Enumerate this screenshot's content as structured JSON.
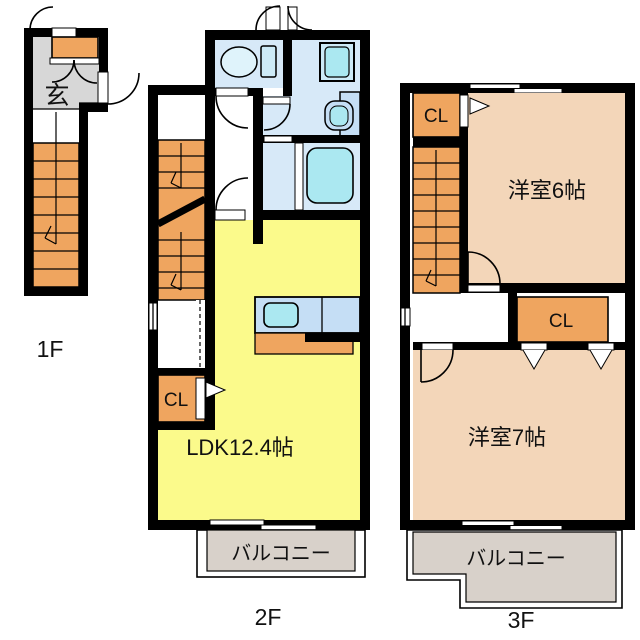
{
  "palette": {
    "wall": "#000000",
    "stair_closet_orange": "#efa55f",
    "ldk_yellow": "#fbfa8b",
    "bedroom_salmon": "#f3d6b9",
    "water_room_blue": "#d7e9f8",
    "fixture_cyan": "#abe8f1",
    "kitchen_counter_blue": "#c5def5",
    "balcony_gray": "#d8d1ca",
    "entrance_gray": "#d7d7d7"
  },
  "floor_1f": {
    "label": "1F",
    "entrance_label": "玄"
  },
  "floor_2f": {
    "label": "2F",
    "ldk_label": "LDK12.4帖",
    "closet_label": "CL",
    "balcony_label": "バルコニー"
  },
  "floor_3f": {
    "label": "3F",
    "closet_top_label": "CL",
    "closet_mid_label": "CL",
    "room6_label": "洋室6帖",
    "room7_label": "洋室7帖",
    "balcony_label": "バルコニー"
  }
}
